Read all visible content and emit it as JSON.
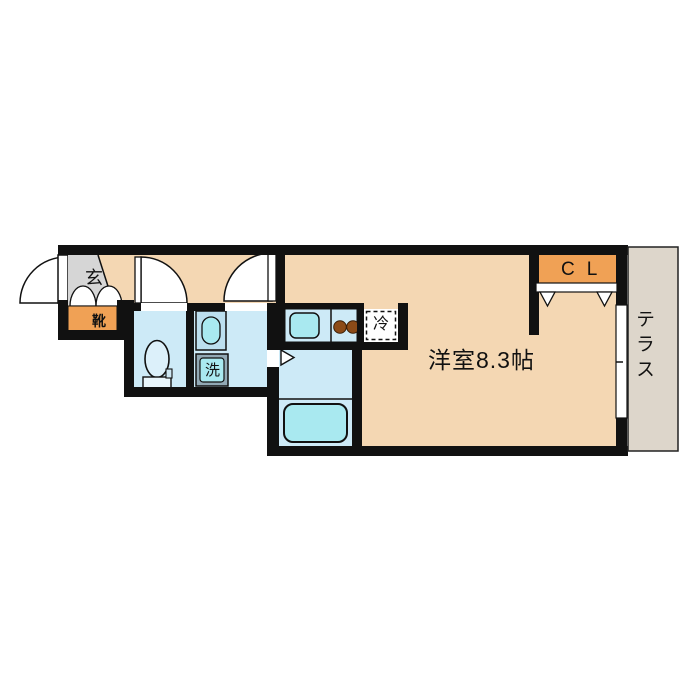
{
  "floor_plan": {
    "labels": {
      "entrance": "玄",
      "shoe_cabinet": "靴",
      "washing_machine": "洗",
      "refrigerator": "冷",
      "main_room": "洋室8.3帖",
      "closet": "CL",
      "terrace": "テラス"
    },
    "colors": {
      "wall": "#111111",
      "room_tan": "#F4D7B3",
      "accent_orange": "#F0A155",
      "wet_area_blue": "#CDEAF7",
      "fixture_cyan": "#A9E9F0",
      "entrance_gray": "#D6D6D6",
      "terrace_gray": "#DDD6CB",
      "burner_brown": "#8C4B18"
    }
  }
}
